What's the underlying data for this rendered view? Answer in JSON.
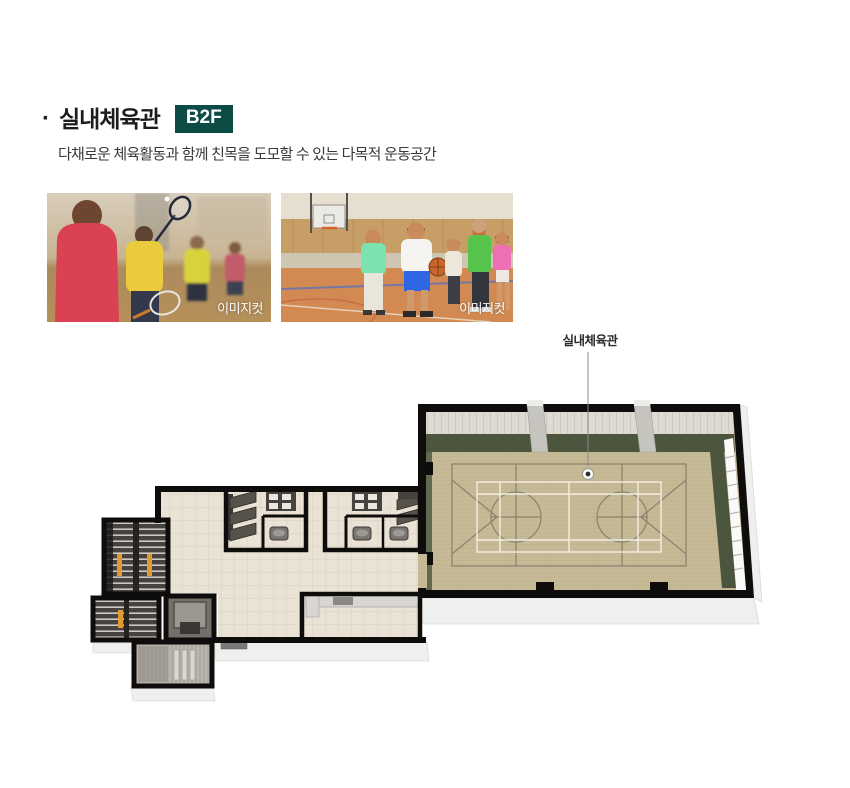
{
  "header": {
    "bullet": "·",
    "title": "실내체육관",
    "badge": "B2F",
    "subtitle": "다채로운 체육활동과 함께 친목을 도모할 수 있는 다목적 운동공간"
  },
  "photos": {
    "left": {
      "caption": "이미지컷",
      "subject": "badminton players in gym"
    },
    "right": {
      "caption": "이미지컷",
      "subject": "kids playing basketball in gym"
    }
  },
  "floorplan": {
    "label": "실내체육관",
    "level": "B2F",
    "rooms": [
      "gymnasium with basketball/badminton court",
      "restrooms",
      "corridor",
      "stairs",
      "elevator",
      "utility room",
      "multipurpose room"
    ]
  },
  "colors": {
    "badge_bg": "#0d4b47",
    "title_text": "#1d1d1b",
    "subtitle_text": "#3a3a38",
    "wall": "#0e0d0c",
    "gym_floor": "#c6b996",
    "green_wall": "#4c553e",
    "court_line_gray": "#8b8470",
    "court_line_white": "#f2eee1",
    "corridor_floor": "#eae3d5",
    "stair_orange": "#e09a31"
  }
}
